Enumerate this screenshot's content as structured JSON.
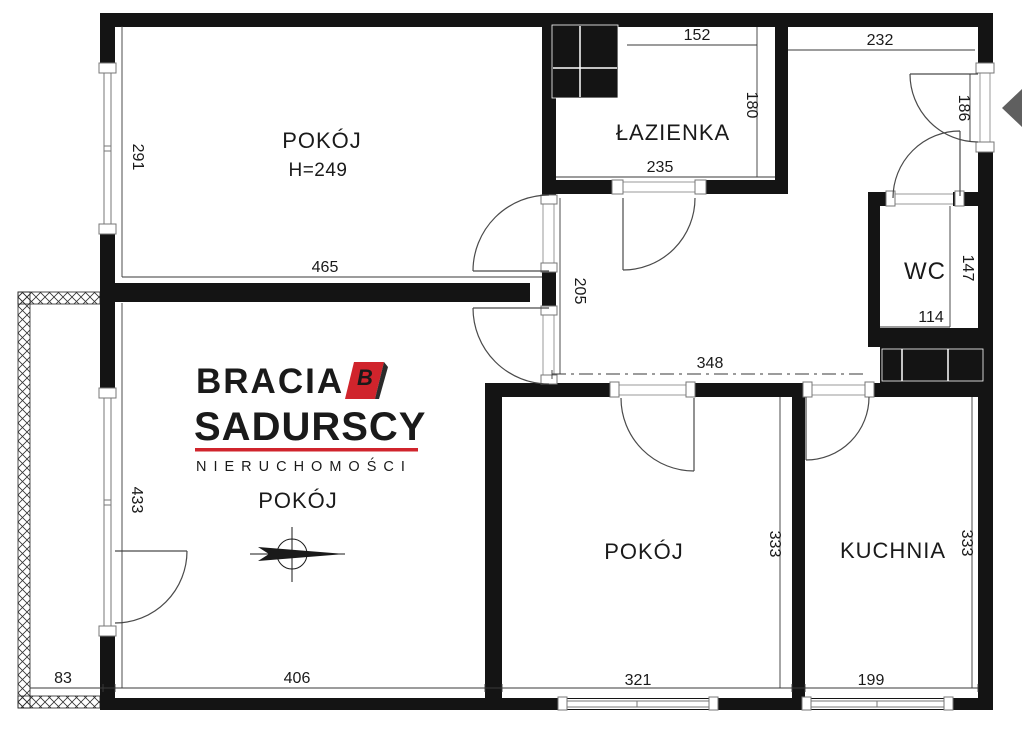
{
  "rooms": {
    "pokoj1": {
      "label": "POKÓJ",
      "height_note": "H=249"
    },
    "lazienka": {
      "label": "ŁAZIENKA"
    },
    "wc": {
      "label": "WC"
    },
    "pokoj2": {
      "label": "POKÓJ"
    },
    "pokoj3": {
      "label": "POKÓJ"
    },
    "kuchnia": {
      "label": "KUCHNIA"
    }
  },
  "dims": {
    "d291": "291",
    "d465": "465",
    "d152": "152",
    "d180": "180",
    "d235": "235",
    "d232": "232",
    "d186": "186",
    "d205": "205",
    "d348": "348",
    "d147": "147",
    "d114": "114",
    "d433": "433",
    "d333_left": "333",
    "d333_right": "333",
    "d83": "83",
    "d406": "406",
    "d321": "321",
    "d199": "199"
  },
  "logo": {
    "brand_top": "BRACIA",
    "brand_bottom": "SADURSCY",
    "tagline": "NIERUCHOMOŚCI",
    "mark_letter": "B",
    "red": "#d0242c",
    "text_color": "#2b2b2b"
  },
  "colors": {
    "wall": "#141414",
    "entrance_arrow": "#5f5f5f"
  }
}
